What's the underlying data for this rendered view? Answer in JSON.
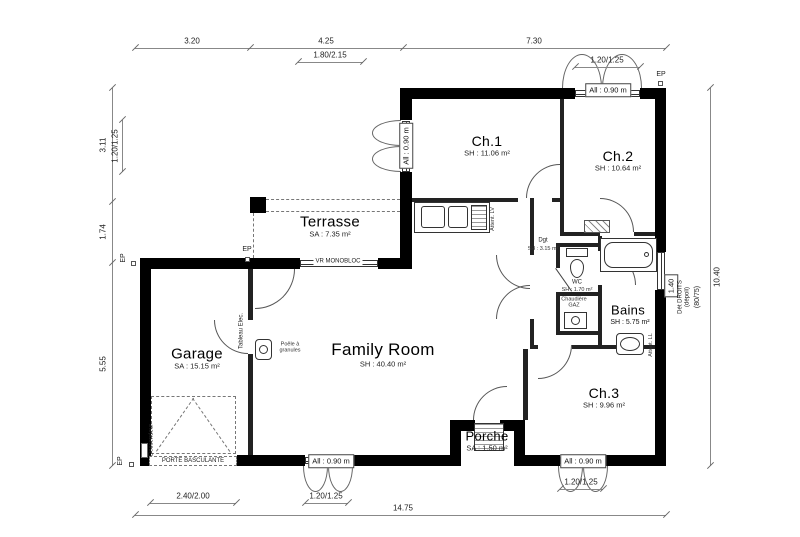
{
  "rooms": {
    "ch1": {
      "name": "Ch.1",
      "area": "SH : 11.06 m²"
    },
    "ch2": {
      "name": "Ch.2",
      "area": "SH : 10.64 m²"
    },
    "ch3": {
      "name": "Ch.3",
      "area": "SH : 9.96 m²"
    },
    "family_room": {
      "name": "Family Room",
      "area": "SH : 40.40 m²"
    },
    "garage": {
      "name": "Garage",
      "area": "SA : 15.15 m²"
    },
    "terrasse": {
      "name": "Terrasse",
      "area": "SA : 7.35 m²"
    },
    "porche": {
      "name": "Porche",
      "area": "SA : 1.50 m²"
    },
    "bains": {
      "name": "Bains",
      "area": "SH : 5.75 m²"
    },
    "degagement": {
      "name": "Dgt",
      "area": "SH : 3.15 m²"
    },
    "wc": {
      "name": "WC",
      "area": "SH : 1.70 m²"
    }
  },
  "equipment": {
    "chaudiere": "Chaudière\nGAZ",
    "poele": "Poêle à\ngranules",
    "tableau_elec": "Tableau Elec.",
    "descendeur": "Descendeur",
    "attente_lv": "Attent. LV",
    "attente_ll": "Attent. LL",
    "vr_monobloc": "VR MONOBLOC",
    "porte_basculante": "PORTE BASCULANTE"
  },
  "windows": {
    "allege_090": "All : 0.90 m",
    "allege_140": "1.40",
    "bains_glass": "Dét DROITS\n(dépoli)"
  },
  "dimensions": {
    "top": {
      "d1": "3.20",
      "d2": "4.25",
      "d3": "7.30",
      "sub1": "1.80/2.15",
      "sub2": "1.20/1.25"
    },
    "left": {
      "d1": "3.11",
      "d2": "1.74",
      "d3": "5.55",
      "sub1": "1.20/1.25"
    },
    "bottom": {
      "d1": "2.40/2.00",
      "d2": "1.20/1.25",
      "d3": "1.20/1.25",
      "total": "14.75"
    },
    "right": {
      "total": "10.40",
      "sub1": "(80/75)"
    }
  },
  "markers": {
    "ep": "EP"
  },
  "colors": {
    "wall": "#000000",
    "line": "#666666",
    "background": "#ffffff"
  }
}
